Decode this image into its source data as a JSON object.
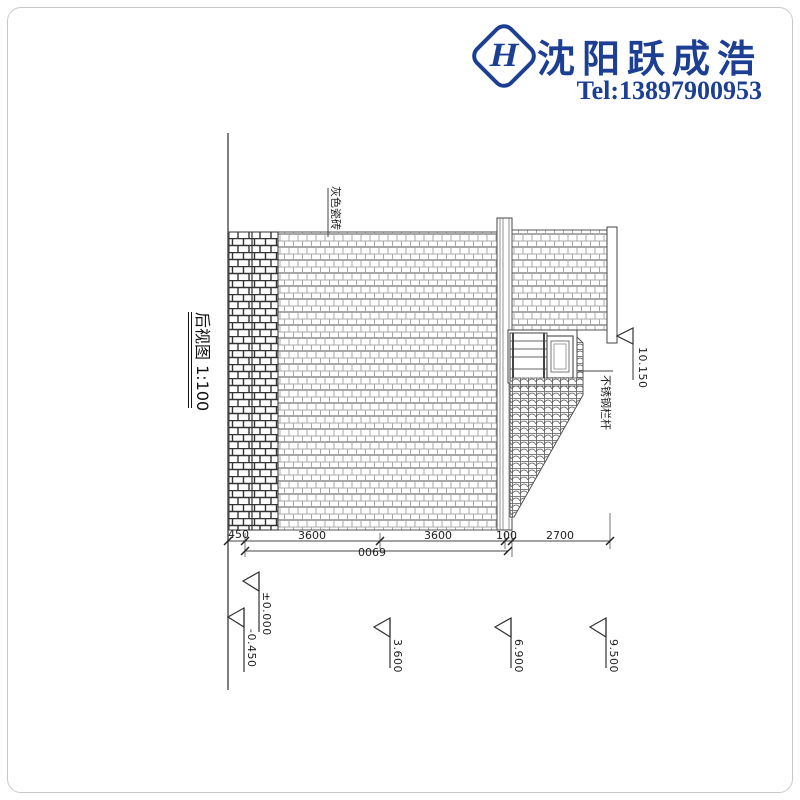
{
  "brand": {
    "company": "沈阳跃成浩",
    "tel": "Tel:13897900953",
    "logo_letter": "H",
    "color": "#1c3f94"
  },
  "drawing": {
    "title": "后视图 1:100",
    "material_label": "灰色瓷砖",
    "railing_label": "不锈钢栏杆",
    "dims": {
      "a": "450",
      "b": "3600",
      "c": "3600",
      "d": "100",
      "e": "2700",
      "total": "0069"
    },
    "levels": {
      "top": "10.150",
      "zero": "±0.000",
      "minus": "-0.450",
      "l1": "3.600",
      "l2": "6.900",
      "l3": "9.500"
    }
  }
}
